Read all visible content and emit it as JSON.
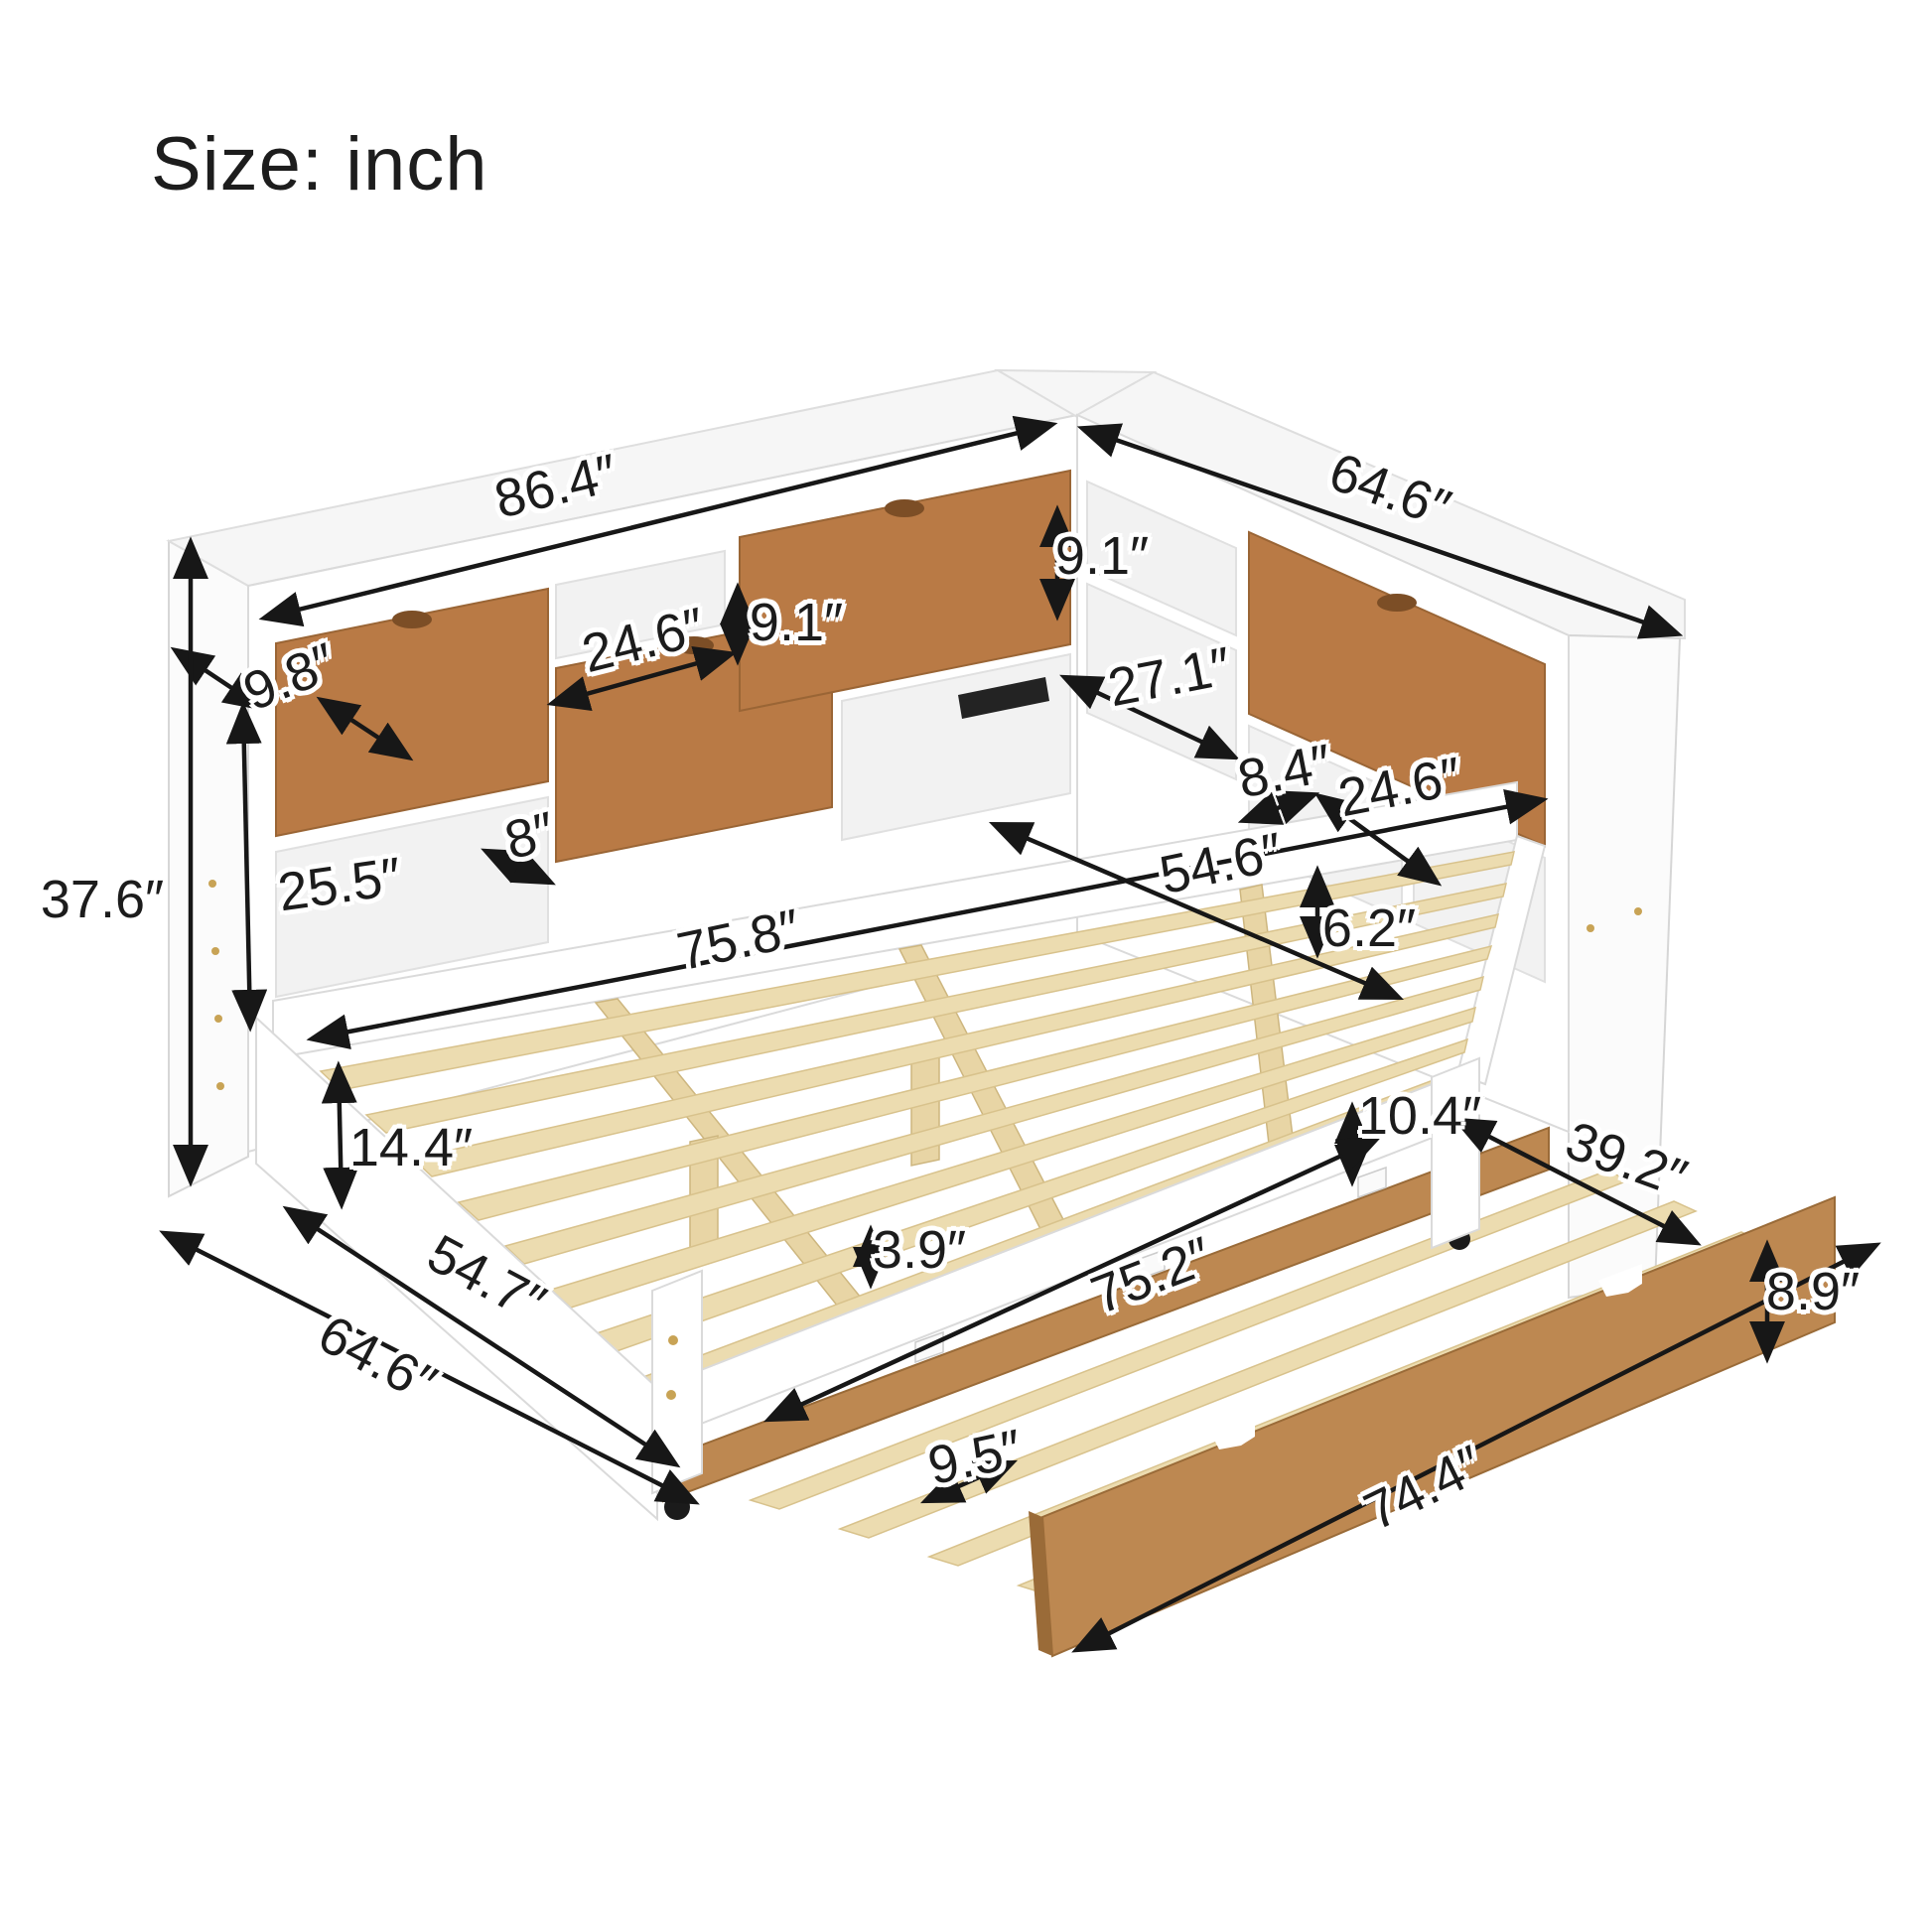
{
  "title": "Size: inch",
  "dimensions": {
    "total_length": "86.4″",
    "total_width_top": "64.6″",
    "bookcase_depth": "9.8″",
    "total_height": "37.6″",
    "left_cubby_width": "24.6″",
    "left_cubby_height": "9.1″",
    "left_open_height": "25.5″",
    "left_small_cubby": "8″",
    "right_cubby_height": "9.1″",
    "right_cubby_width": "27.1″",
    "right_small_cubby": "8.4″",
    "right_drawer_width": "24.6″",
    "bed_width": "54.6″",
    "rail_height": "6.2″",
    "bed_length": "75.8″",
    "frame_height": "14.4″",
    "trundle_clearance": "10.4″",
    "trundle_width": "39.2″",
    "slat_rail_height": "3.9″",
    "trundle_length": "75.2″",
    "trundle_panel_height": "8.9″",
    "side_length": "54.7″",
    "total_width_bottom": "64.6″",
    "slat_spacing": "9.5″",
    "trundle_front_length": "74.4″"
  },
  "colors": {
    "wood_drawer": "#b97a45",
    "wood_trundle": "#bd8851",
    "wood_slat": "#ecdcb0",
    "line": "#171717"
  }
}
